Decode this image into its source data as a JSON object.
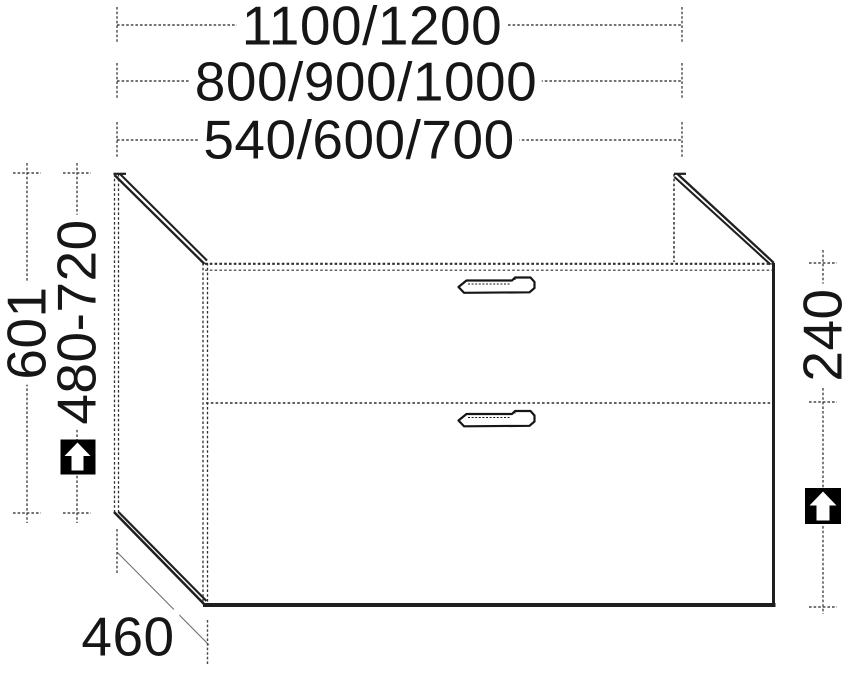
{
  "drawing": {
    "type": "furniture-technical-drawing",
    "subject": "two-drawer vanity base cabinet, perspective line drawing"
  },
  "dimensions": {
    "top_row_1": "1100/1200",
    "top_row_2": "800/900/1000",
    "top_row_3": "540/600/700",
    "left_outer": "601",
    "left_inner": "480-720",
    "right": "240",
    "bottom": "460"
  },
  "icons": {
    "left_height_adjust": "up-arrow-in-black-square",
    "right_height_adjust": "up-arrow-in-black-square"
  },
  "colors": {
    "line": "#1f1f1f",
    "dim_line": "#474747",
    "background": "#ffffff",
    "icon_bg": "#000000",
    "icon_arrow": "#ffffff",
    "text": "#161616"
  }
}
